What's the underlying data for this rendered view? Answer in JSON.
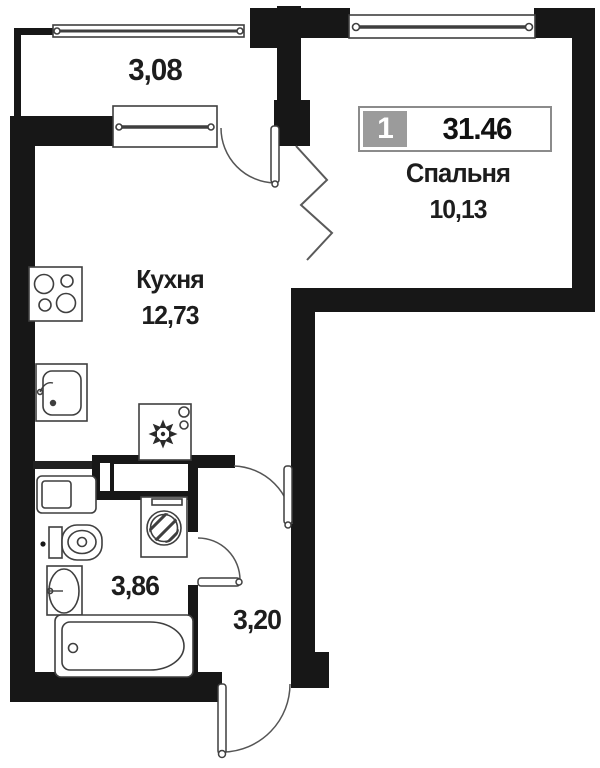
{
  "plan_title": {
    "unit_number": "1",
    "total_area": "31.46"
  },
  "rooms": {
    "balcony": {
      "area": "3,08"
    },
    "bedroom": {
      "name": "Спальня",
      "area": "10,13"
    },
    "kitchen": {
      "name": "Кухня",
      "area": "12,73"
    },
    "bathroom": {
      "area": "3,86"
    },
    "hallway": {
      "area": "3,20"
    }
  },
  "colors": {
    "wall": "#171717",
    "fixture_line": "#3f3f3f",
    "background": "#ffffff",
    "badge_number_bg": "#9b9b9b",
    "badge_border": "#8b8b8b",
    "text": "#1d1d1d"
  },
  "icons": [
    "stove-icon",
    "kitchen-sink-icon",
    "fridge-icon",
    "washing-machine-icon",
    "vanity-icon",
    "toilet-icon",
    "washbasin-icon",
    "bathtub-icon",
    "window-icon",
    "door-arc-icon",
    "wall-break-zigzag-icon"
  ]
}
